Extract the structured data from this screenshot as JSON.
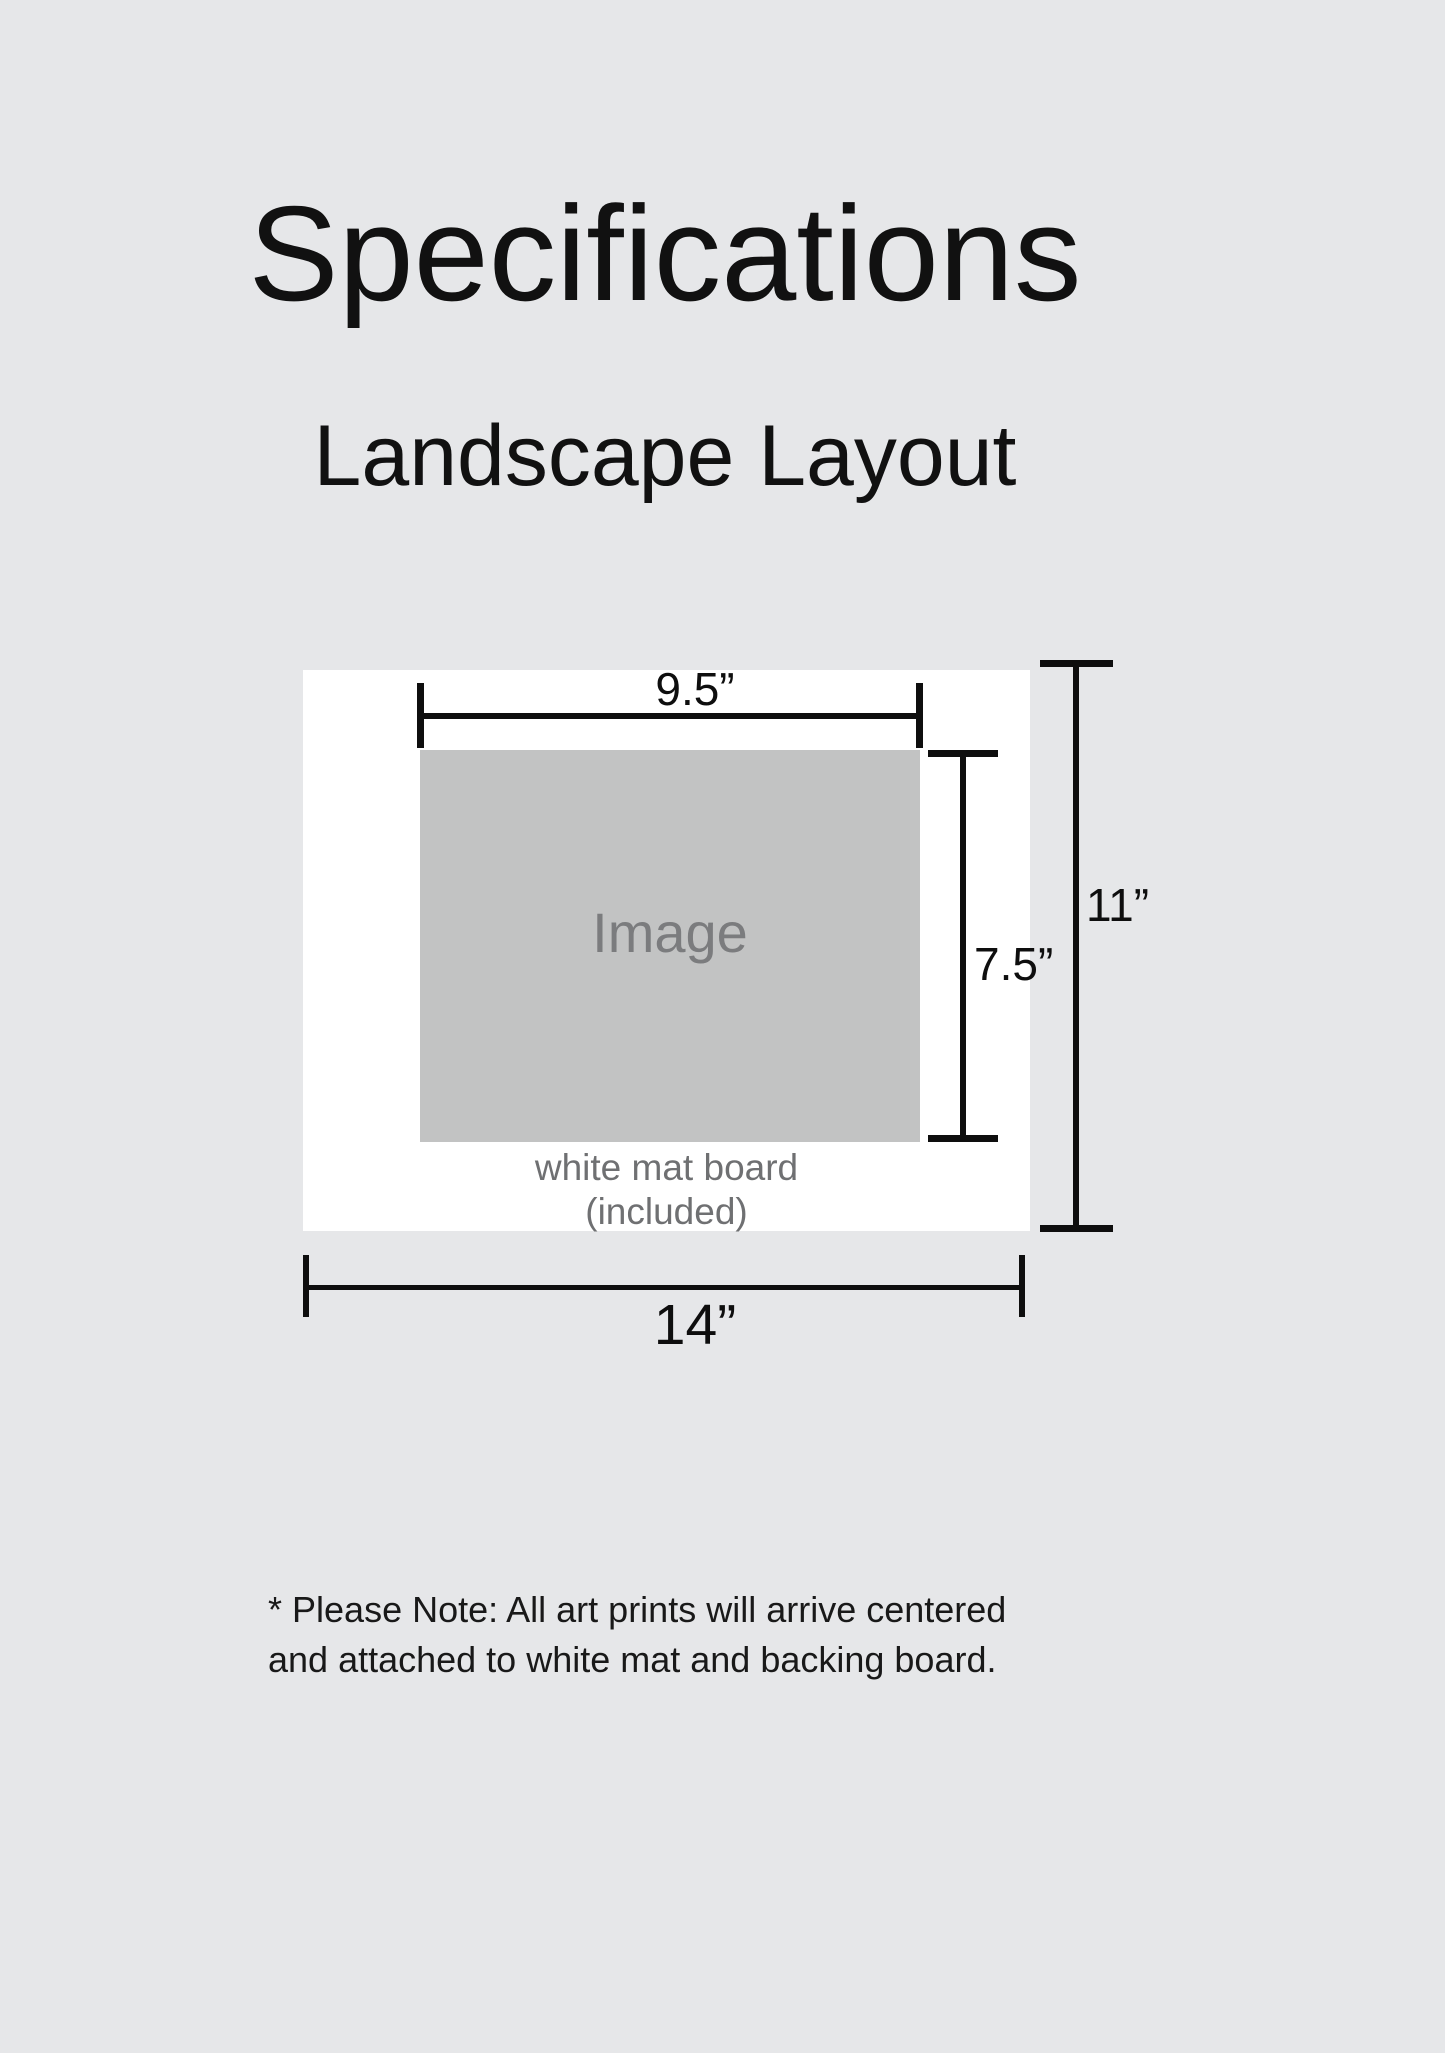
{
  "page": {
    "title": "Specifications",
    "subtitle": "Landscape Layout",
    "background_color": "#e6e7e9",
    "note": {
      "line1": "* Please Note: All art prints will arrive centered",
      "line2": "and attached to white mat and backing board."
    }
  },
  "diagram": {
    "mat_board": {
      "label_line1": "white mat board",
      "label_line2": "(included)",
      "color": "#ffffff",
      "width_label": "14”",
      "height_label": "11”"
    },
    "image": {
      "label": "Image",
      "color": "#c2c3c3",
      "label_color": "#7b7c7e",
      "width_label": "9.5”",
      "height_label": "7.5”"
    },
    "line_color": "#0e0e0e",
    "mat_label_color": "#6f7072"
  }
}
